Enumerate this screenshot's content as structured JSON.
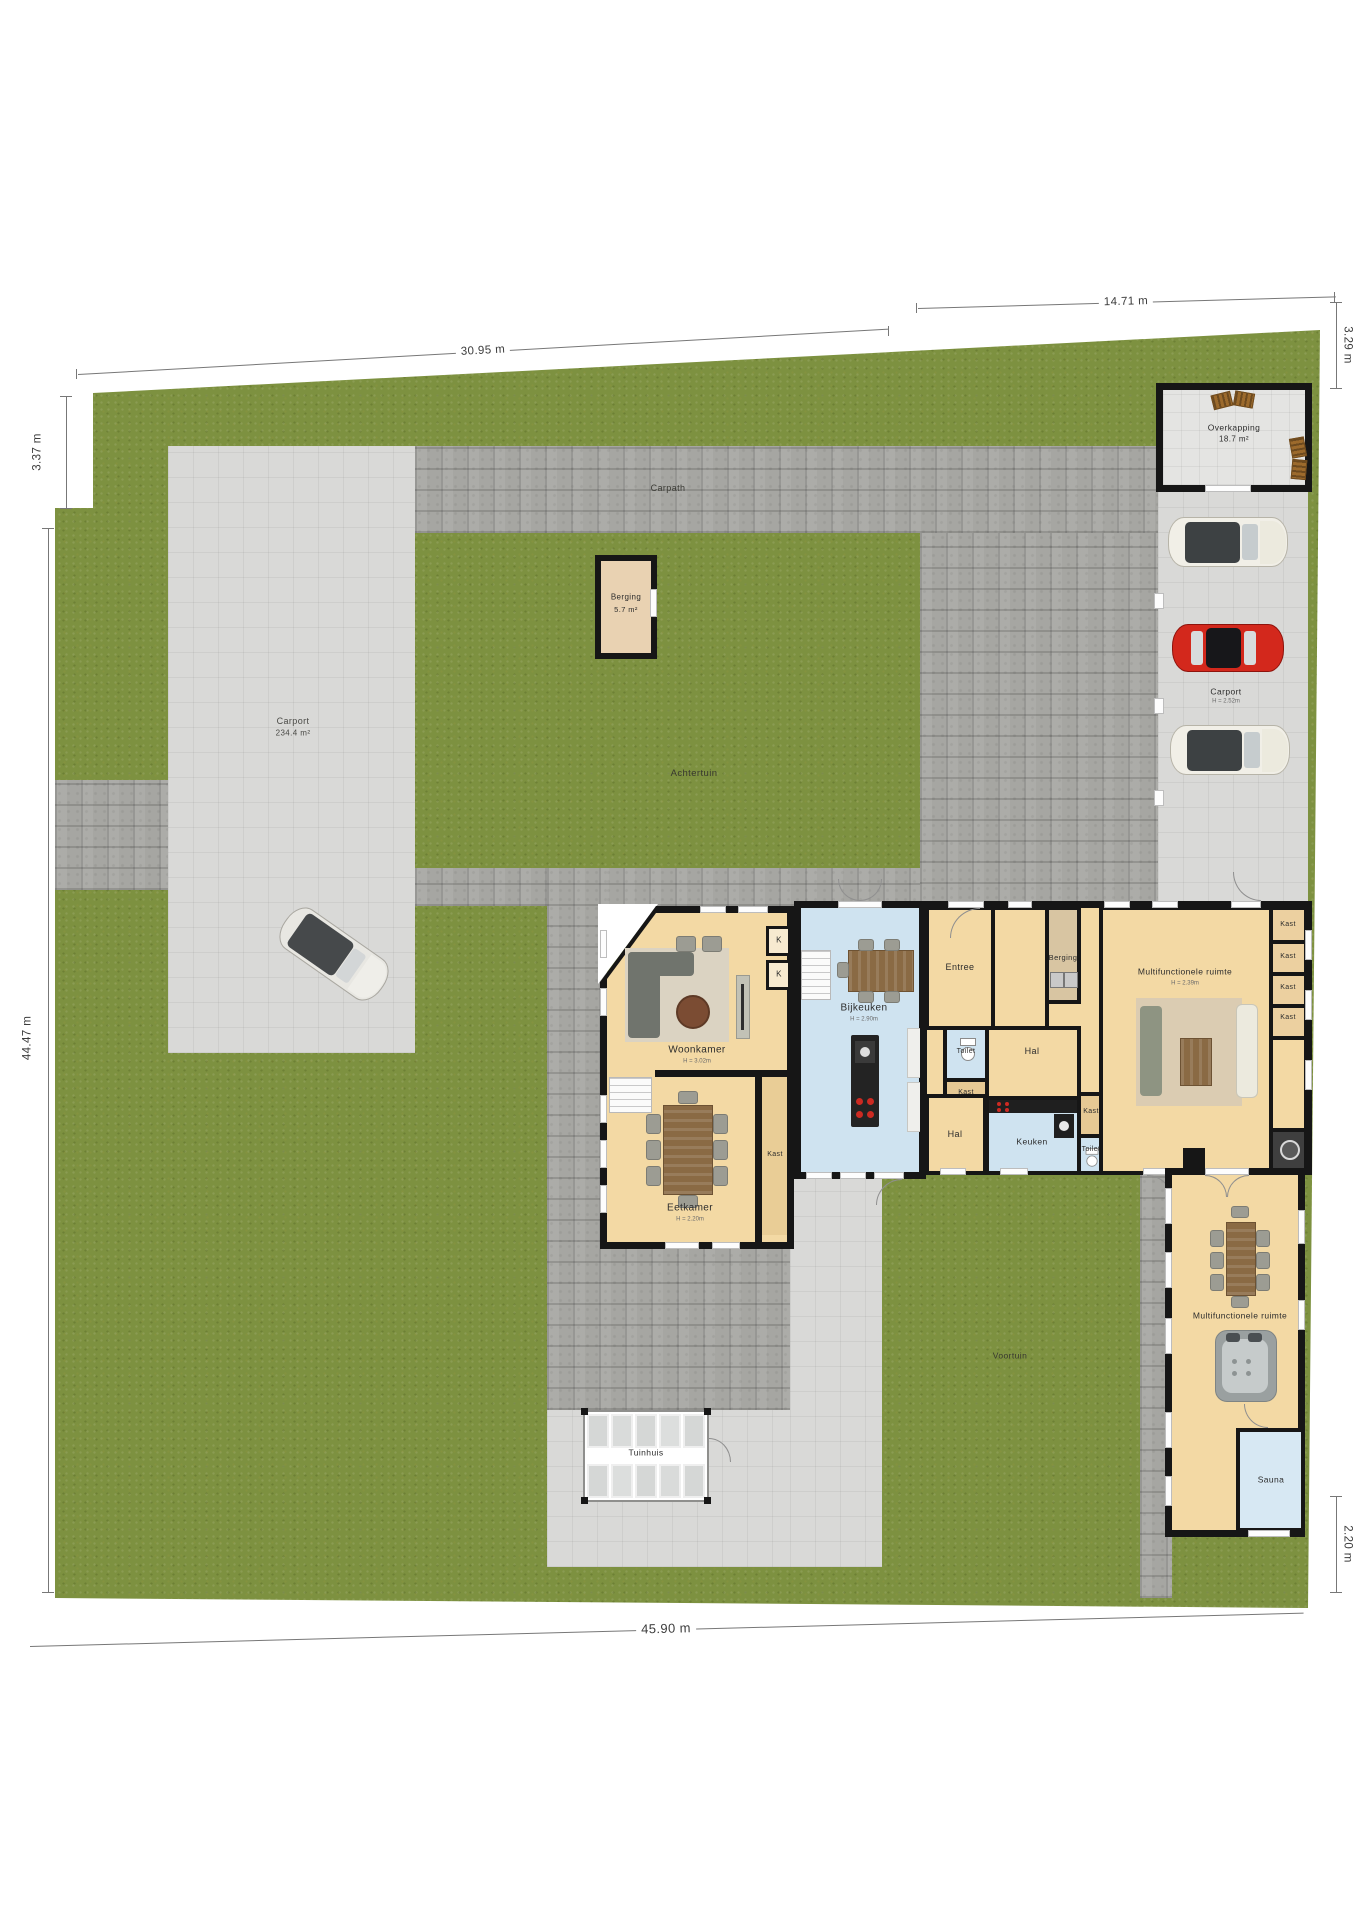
{
  "dimensions": {
    "top_left": "30.95 m",
    "top_right": "14.71 m",
    "left_upper": "3.37 m",
    "right_upper": "3.29 m",
    "left_side": "44.47 m",
    "right_lower": "2.20 m",
    "bottom": "45.90 m"
  },
  "garden": {
    "carpath": "Carpath",
    "achtertuin": "Achtertuin",
    "voortuin": "Voortuin",
    "tuinhuis": "Tuinhuis",
    "carport_area": {
      "label": "Carport",
      "area": "234.4 m²"
    },
    "carport_right": {
      "label": "Carport",
      "height": "H = 2.52m"
    },
    "overkapping": {
      "label": "Overkapping",
      "area": "18.7 m²"
    },
    "garden_shed": {
      "label": "Berging",
      "area": "5.7 m²"
    }
  },
  "rooms": {
    "woonkamer": {
      "label": "Woonkamer",
      "height": "H = 3.02m"
    },
    "eetkamer": {
      "label": "Eetkamer",
      "height": "H = 2.20m"
    },
    "bijkeuken": {
      "label": "Bijkeuken",
      "height": "H = 2.90m"
    },
    "entree": {
      "label": "Entree"
    },
    "berging": {
      "label": "Berging"
    },
    "toilet": {
      "label": "Toilet"
    },
    "hal": {
      "label": "Hal"
    },
    "keuken": {
      "label": "Keuken"
    },
    "kast": {
      "label": "Kast"
    },
    "kast_short": {
      "label": "K"
    },
    "multifunctioneel_1": {
      "label": "Multifunctionele ruimte",
      "height": "H = 2.39m"
    },
    "multifunctioneel_2": {
      "label": "Multifunctionele ruimte"
    },
    "sauna": {
      "label": "Sauna"
    }
  }
}
